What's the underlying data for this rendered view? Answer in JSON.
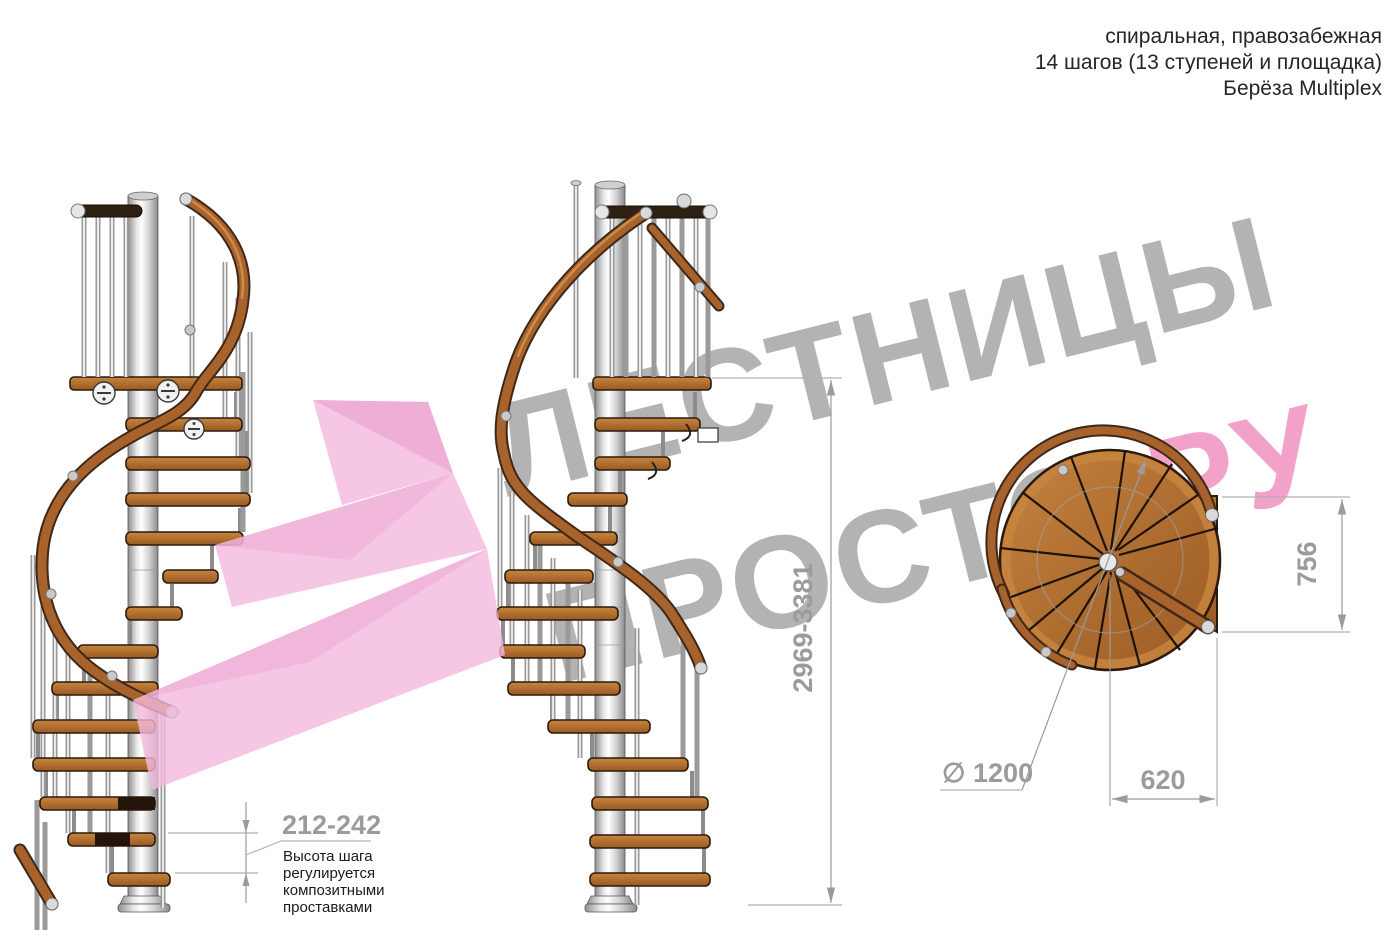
{
  "header": {
    "line1": "спиральная, правозабежная",
    "line2": "14 шагов (13 ступеней и площадка)",
    "line3": "Берёза Multiplex"
  },
  "watermark": {
    "line1": "ЛЕСТНИЦЫ",
    "line2_gray": "ПРОСТО",
    "line2_dot": ".",
    "line2_pink": "РУ",
    "gray_color": "#b3b3b3",
    "pink_color": "#f2a2c8",
    "dot_color": "#e2557f",
    "logo_pink": "#f4b9dd"
  },
  "annotations": {
    "step_height": {
      "value": "212-242",
      "note_line1": "Высота шага",
      "note_line2": "регулируется",
      "note_line3": "композитными",
      "note_line4": "проставками"
    },
    "total_height": "2969-3381",
    "landing_depth": "756",
    "landing_width": "620",
    "diameter": "∅ 1200"
  },
  "colors": {
    "wood": "#a8632c",
    "wood_dark_rail": "#3f2817",
    "metal_pole": "#d9d9d9",
    "dimension_gray": "#9b9b9b",
    "text_black": "#262626"
  }
}
